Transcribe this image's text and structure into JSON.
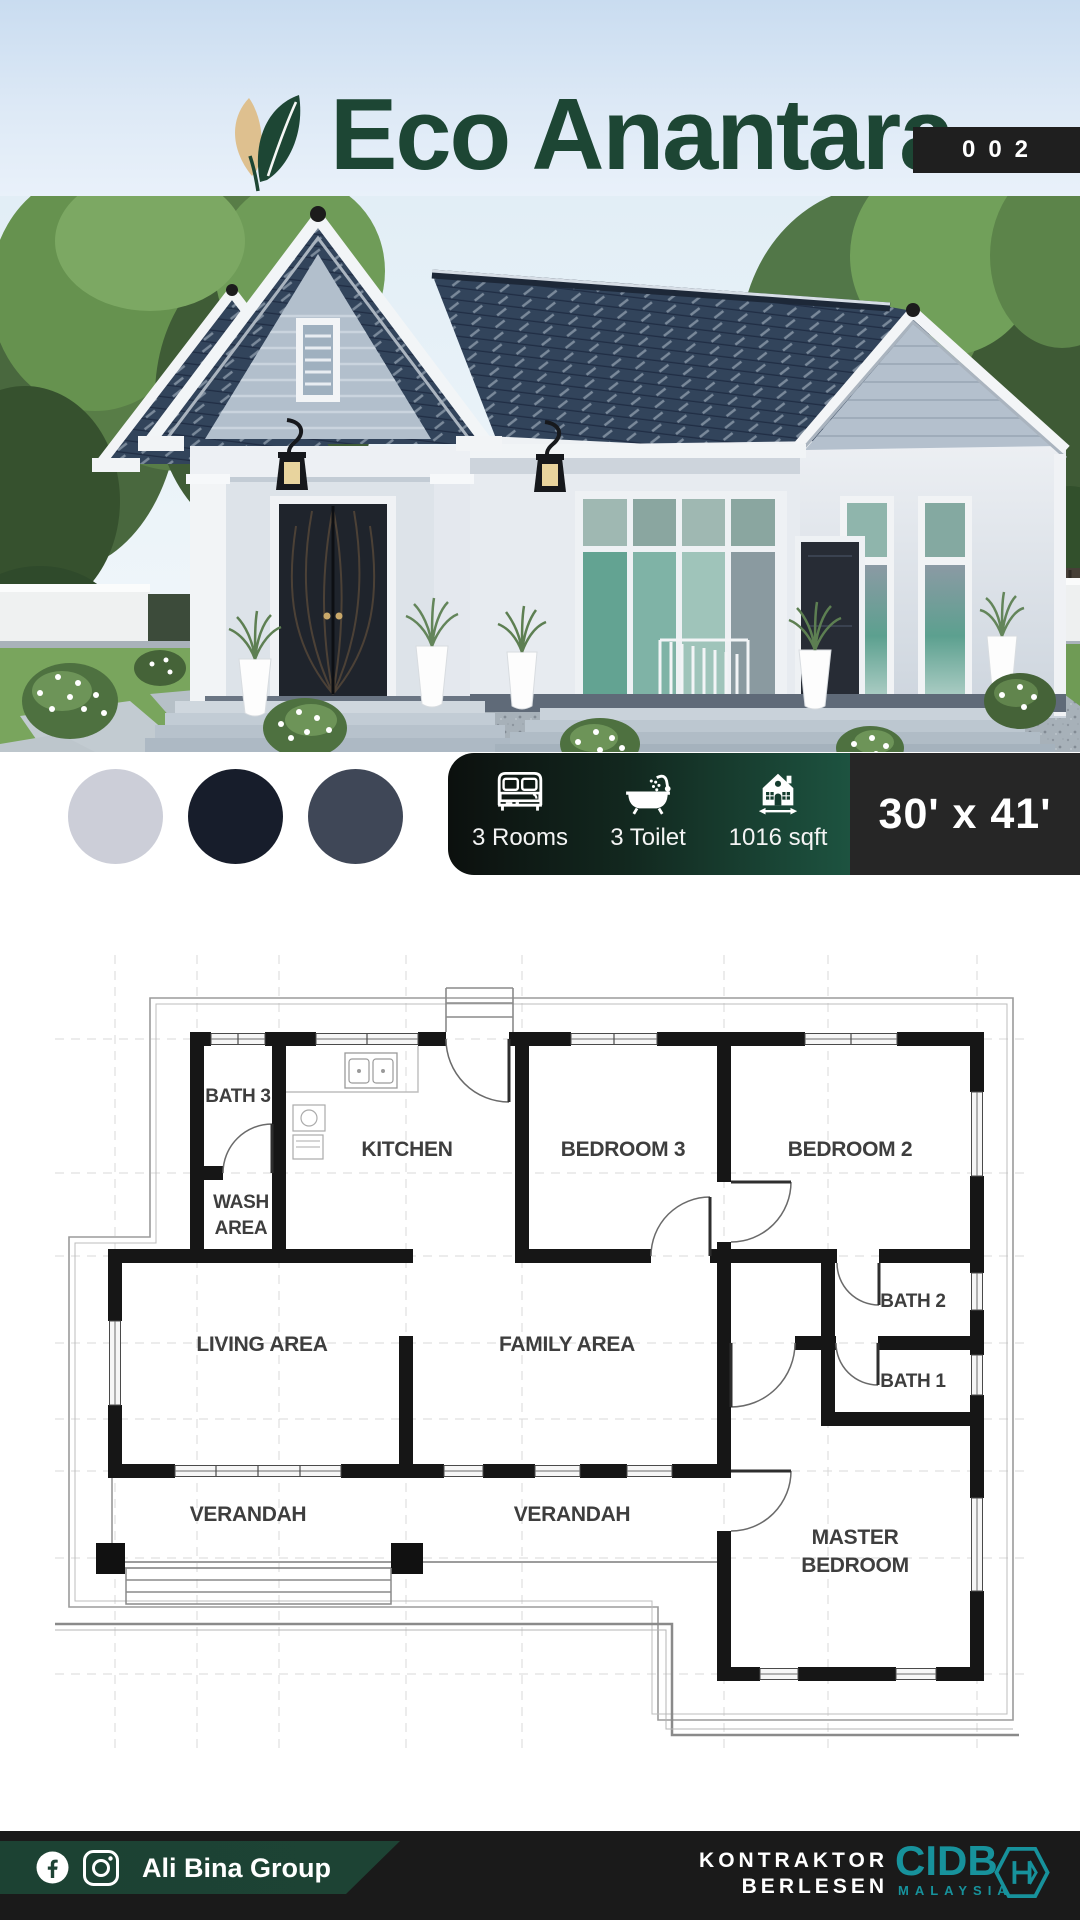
{
  "header": {
    "brand": "Eco Anantara",
    "badge": "002"
  },
  "palette": {
    "swatches": [
      {
        "name": "light-gray",
        "hex": "#ccced8"
      },
      {
        "name": "dark-navy",
        "hex": "#171d2b"
      },
      {
        "name": "slate-gray",
        "hex": "#3f4757"
      }
    ]
  },
  "specs": {
    "rooms_icon": "bed-icon",
    "rooms_label": "3 Rooms",
    "toilet_icon": "bathtub-icon",
    "toilet_label": "3 Toilet",
    "area_icon": "house-width-icon",
    "area_label": "1016 sqft",
    "dimensions": "30' x 41'"
  },
  "floor_plan": {
    "labels": {
      "bath3": "BATH 3",
      "kitchen": "KITCHEN",
      "bedroom3": "BEDROOM 3",
      "bedroom2": "BEDROOM 2",
      "wash_line1": "WASH",
      "wash_line2": "AREA",
      "living": "LIVING AREA",
      "family": "FAMILY AREA",
      "bath2": "BATH 2",
      "bath1": "BATH 1",
      "verandah_left": "VERANDAH",
      "verandah_right": "VERANDAH",
      "master_line1": "MASTER",
      "master_line2": "BEDROOM"
    }
  },
  "footer": {
    "company": "Ali Bina Group",
    "license_line1": "KONTRAKTOR",
    "license_line2": "BERLESEN",
    "cidb_name": "CIDB",
    "cidb_country": "MALAYSIA"
  },
  "colors": {
    "brand_green": "#1d4634",
    "leaf_tan": "#dec08f",
    "badge_black": "#1f1f1f",
    "info_gradient_start": "#0c100e",
    "info_gradient_end": "#1d5340",
    "dim_box_black": "#262626",
    "footer_black": "#1a1a1a",
    "banner_green": "#1d4334",
    "accent_teal": "#17929c",
    "roof_blue": "#32445b"
  }
}
